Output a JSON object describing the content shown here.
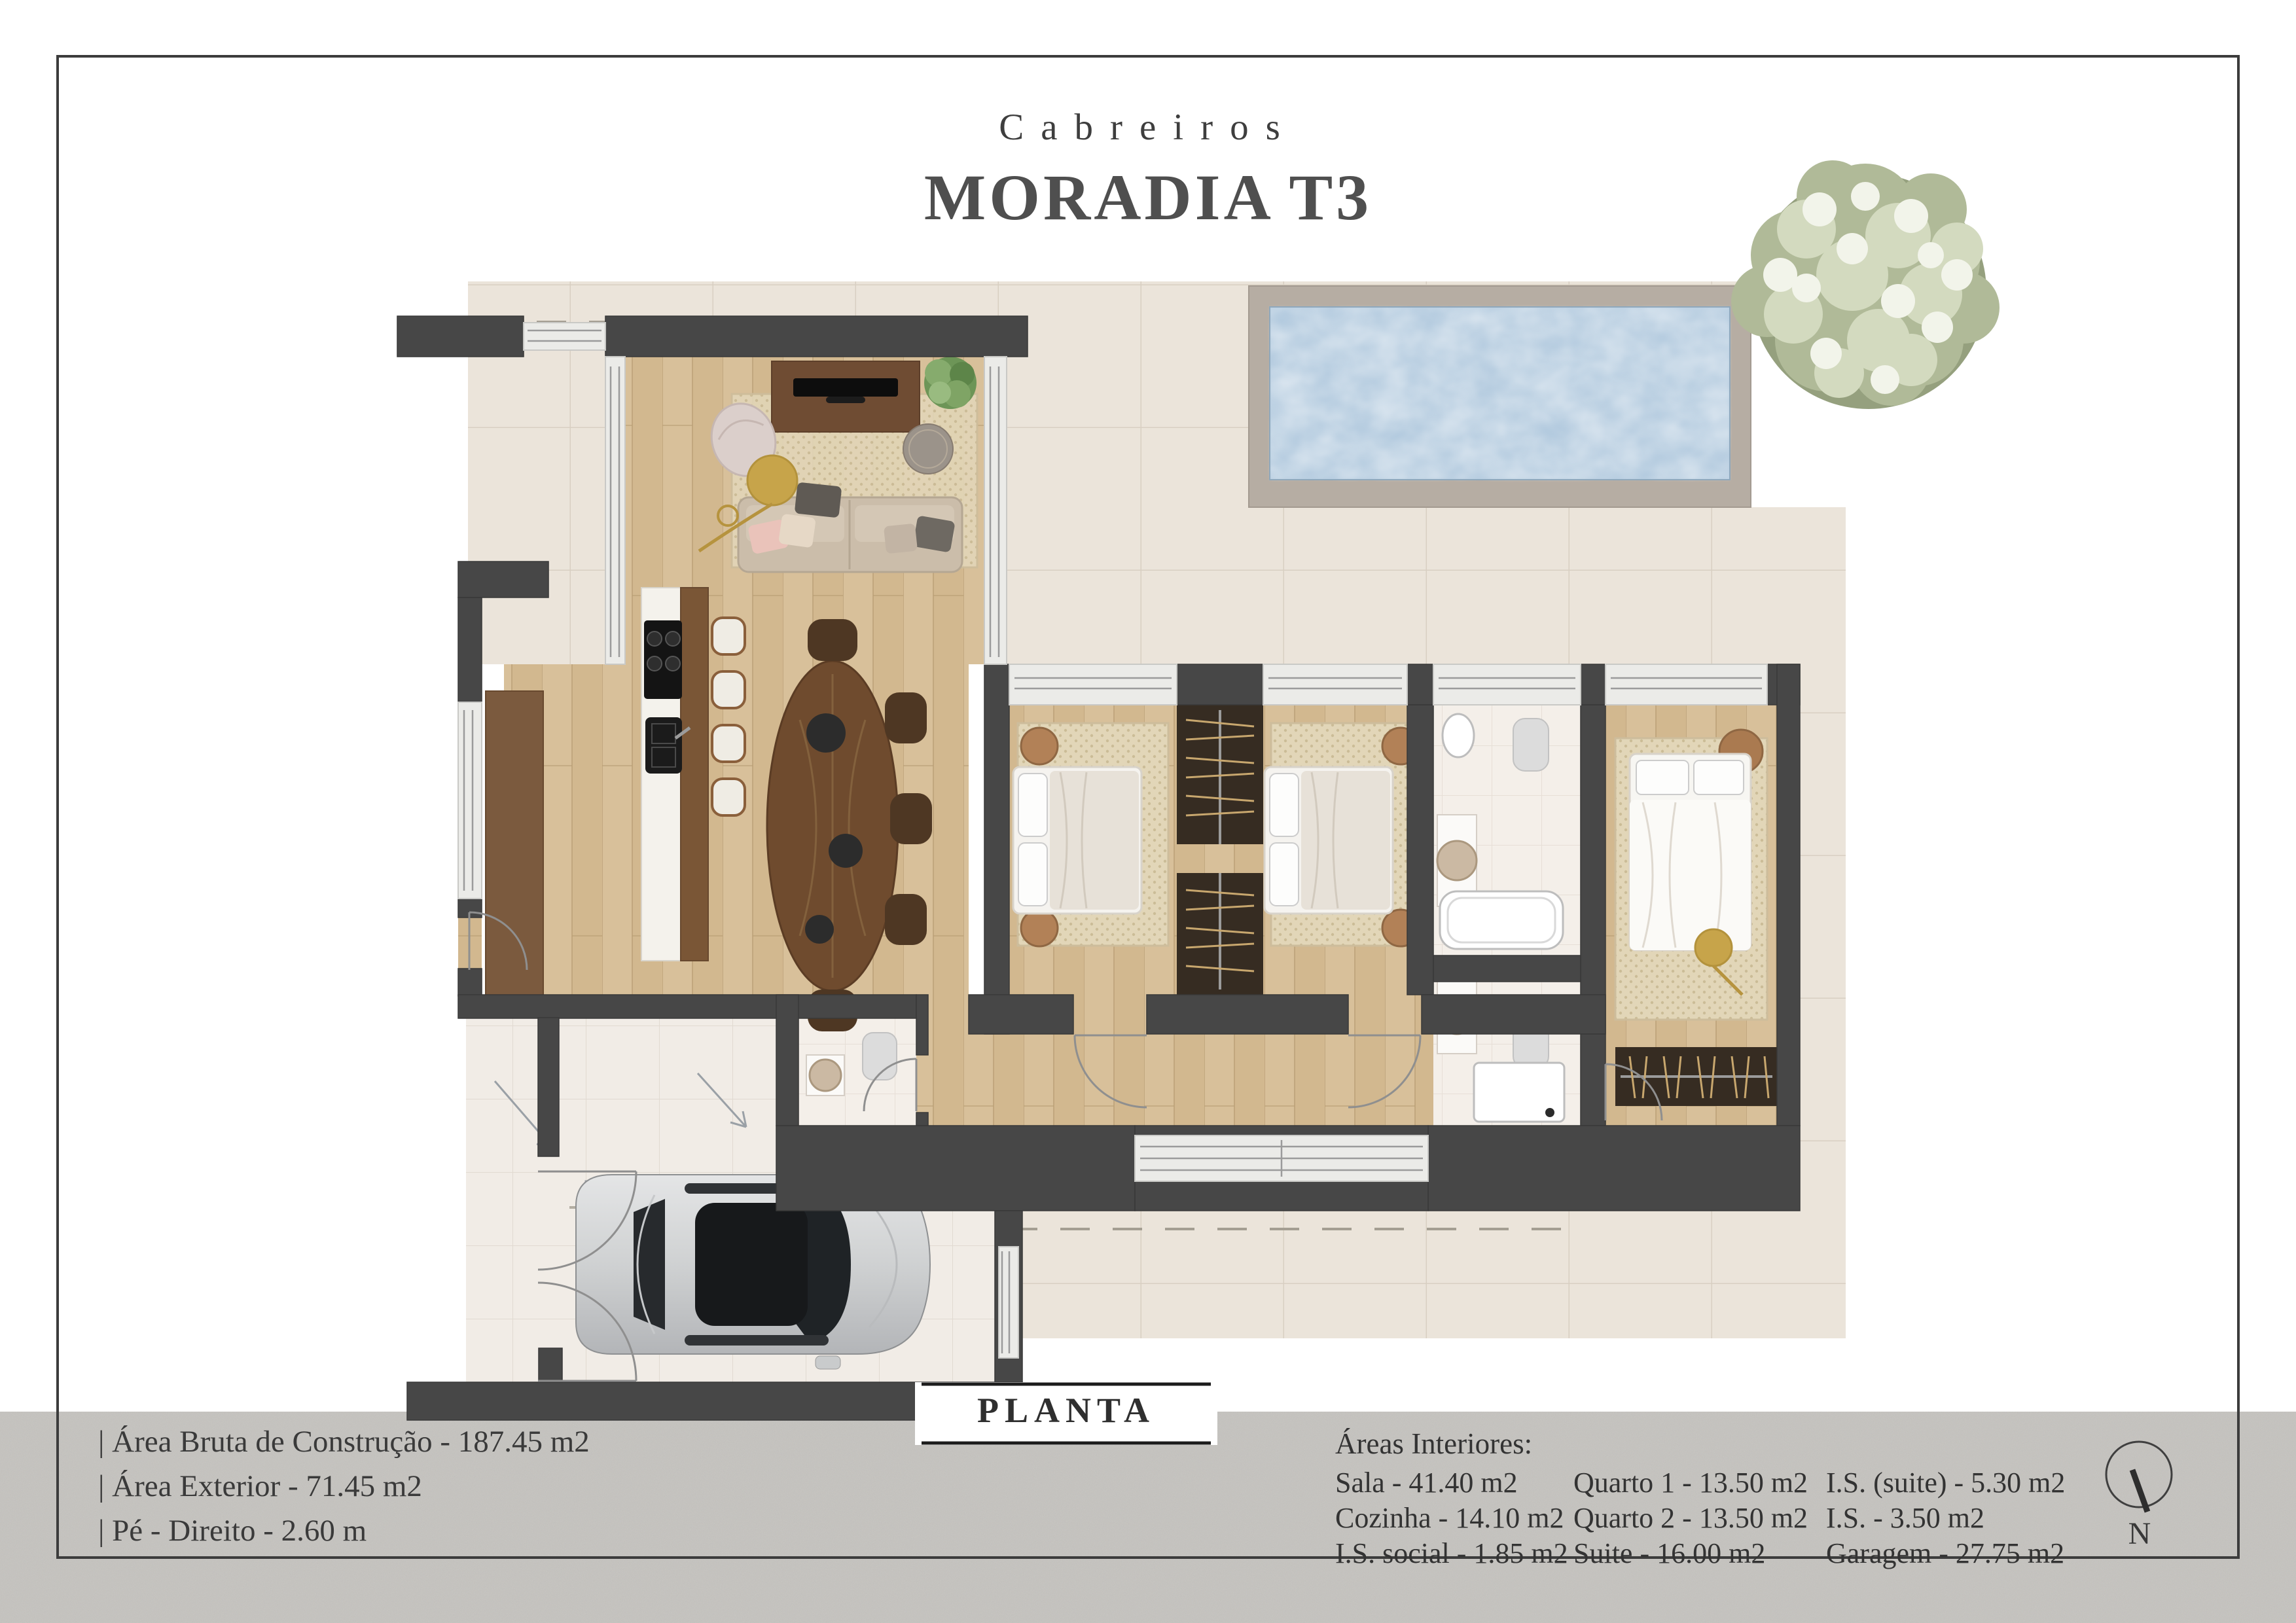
{
  "header": {
    "brand": "Cabreiros",
    "title": "MORADIA T3"
  },
  "plan": {
    "label": "PLANTA"
  },
  "specs": {
    "items": [
      "| Área Bruta de Construção - 187.45 m2",
      "| Área Exterior - 71.45 m2",
      "| Pé - Direito - 2.60 m"
    ]
  },
  "areas": {
    "heading": "Áreas Interiores:",
    "col1": [
      "Sala - 41.40 m2",
      "Cozinha - 14.10 m2",
      "I.S. social - 1.85 m2"
    ],
    "col2": [
      "Quarto 1 - 13.50 m2",
      "Quarto 2 - 13.50 m2",
      "Suite - 16.00 m2"
    ],
    "col3": [
      "I.S. (suite) - 5.30 m2",
      "I.S. - 3.50 m2",
      "Garagem - 27.75 m2"
    ]
  },
  "compass": {
    "label": "N"
  },
  "colors": {
    "wall": "#474747",
    "terrace": "#ebe4da",
    "wood_floor": "#d2b88f",
    "pool_water": "#b4cbdf",
    "pool_coping": "#b6ada3",
    "bottom_band": "#c9c7c3",
    "text": "#3b3b3b"
  }
}
